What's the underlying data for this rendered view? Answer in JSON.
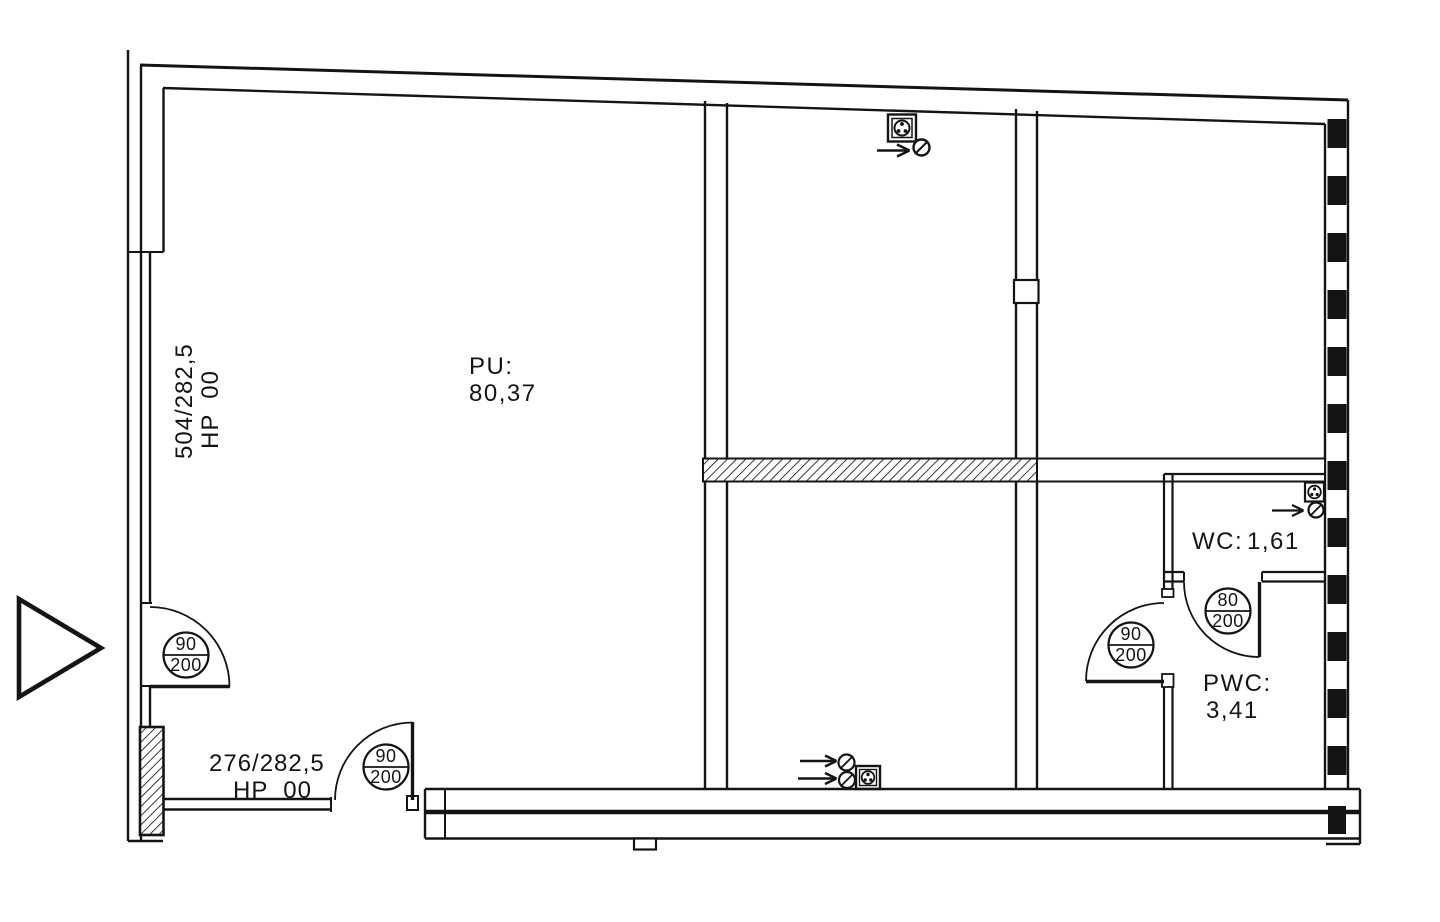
{
  "drawing_title": "Floor plan",
  "rooms": {
    "pu": {
      "label": "PU:",
      "area": "80,37"
    },
    "wc": {
      "label": "WC:",
      "area": "1,61"
    },
    "pwc": {
      "label": "PWC:",
      "area": "3,41"
    }
  },
  "dimensions": {
    "left": {
      "size": "504/282,5",
      "ref": "HP  00"
    },
    "bottom": {
      "size": "276/282,5",
      "ref": "HP  00"
    }
  },
  "doors": {
    "entry": {
      "width": "90",
      "height": "200"
    },
    "terrace": {
      "width": "90",
      "height": "200"
    },
    "pwc": {
      "width": "90",
      "height": "200"
    },
    "wc": {
      "width": "80",
      "height": "200"
    }
  },
  "colors": {
    "line": "#141414",
    "background": "#ffffff"
  }
}
